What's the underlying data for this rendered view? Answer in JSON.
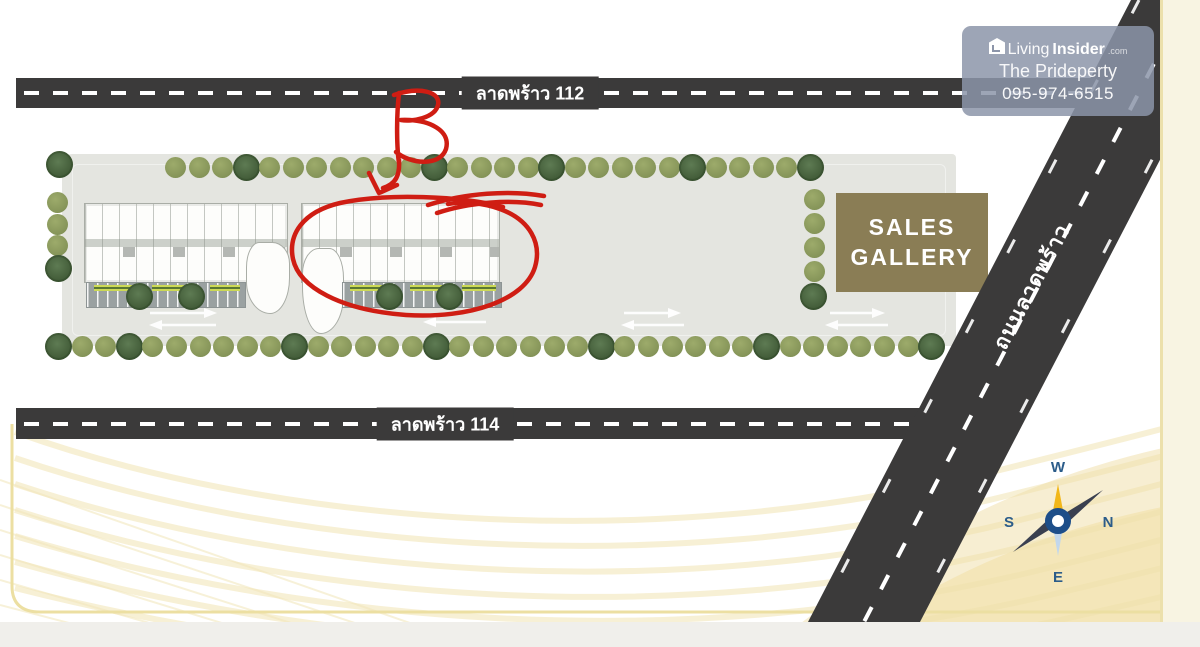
{
  "watermark": {
    "brand_prefix": "Living",
    "brand_suffix": "Insider",
    "brand_tld": ".com",
    "owner": "The Prideperty",
    "phone": "095-974-6515"
  },
  "roads": {
    "top_label": "ลาดพร้าว 112",
    "bottom_label": "ลาดพร้าว 114",
    "diagonal_label": "ถนนลาดพร้าว"
  },
  "sales_gallery": {
    "line1": "SALES",
    "line2": "GALLERY"
  },
  "compass": {
    "top": "W",
    "left": "S",
    "right": "N",
    "bottom": "E"
  },
  "annotation": {
    "label": "B"
  },
  "colors": {
    "road": "#3b3a3a",
    "site": "#e4e5e0",
    "sales_gallery": "#8a7d55",
    "tree_olive": "#87965a",
    "tree_dark": "#455f3b",
    "annotation_red": "#cf1d13",
    "wave_yellow": "#f0e2ac",
    "watermark_bg": "rgba(140,149,169,0.85)"
  },
  "trees": {
    "rows": [
      {
        "y": 157,
        "x": 165,
        "dx": 23.5,
        "count": 28,
        "dark": [
          3,
          11,
          16,
          22,
          27
        ]
      },
      {
        "y": 336,
        "x": 48,
        "dx": 23.6,
        "count": 38,
        "dark": [
          0,
          3,
          10,
          16,
          23,
          30,
          37
        ]
      }
    ],
    "singles": [
      {
        "x": 46,
        "y": 151,
        "dark": true
      },
      {
        "x": 47,
        "y": 192,
        "dark": false
      },
      {
        "x": 47,
        "y": 214,
        "dark": false
      },
      {
        "x": 47,
        "y": 235,
        "dark": false
      },
      {
        "x": 45,
        "y": 255,
        "dark": true
      },
      {
        "x": 804,
        "y": 189,
        "dark": false
      },
      {
        "x": 804,
        "y": 213,
        "dark": false
      },
      {
        "x": 804,
        "y": 237,
        "dark": false
      },
      {
        "x": 804,
        "y": 261,
        "dark": false
      },
      {
        "x": 800,
        "y": 283,
        "dark": true
      },
      {
        "x": 126,
        "y": 283,
        "dark": true
      },
      {
        "x": 178,
        "y": 283,
        "dark": true
      },
      {
        "x": 376,
        "y": 283,
        "dark": true
      },
      {
        "x": 436,
        "y": 283,
        "dark": true
      }
    ]
  }
}
